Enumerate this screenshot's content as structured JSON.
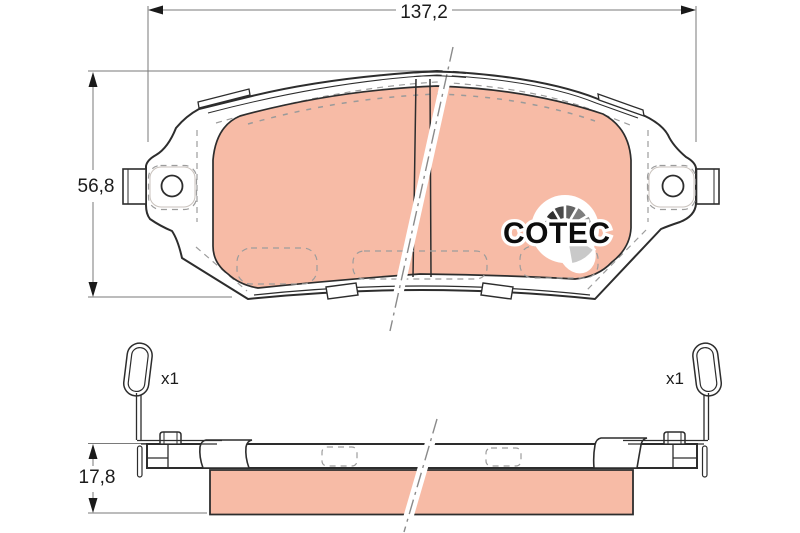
{
  "dimensions": {
    "width": "137,2",
    "height": "56,8",
    "thickness": "17,8"
  },
  "clips": {
    "left_quantity": "x1",
    "right_quantity": "x1"
  },
  "logo": {
    "text": "COTEC"
  },
  "colors": {
    "friction_material": "#f7bba6",
    "outline": "#2d2d2d",
    "dimension_line": "#7a7a7a",
    "hidden_line": "#9c9c9c",
    "logo_text": "#0d0d0d",
    "fan_shades": [
      "#161616",
      "#303030",
      "#4a4a4a",
      "#646464",
      "#7e7e7e",
      "#989898",
      "#acacac",
      "#c9c9c9"
    ]
  }
}
